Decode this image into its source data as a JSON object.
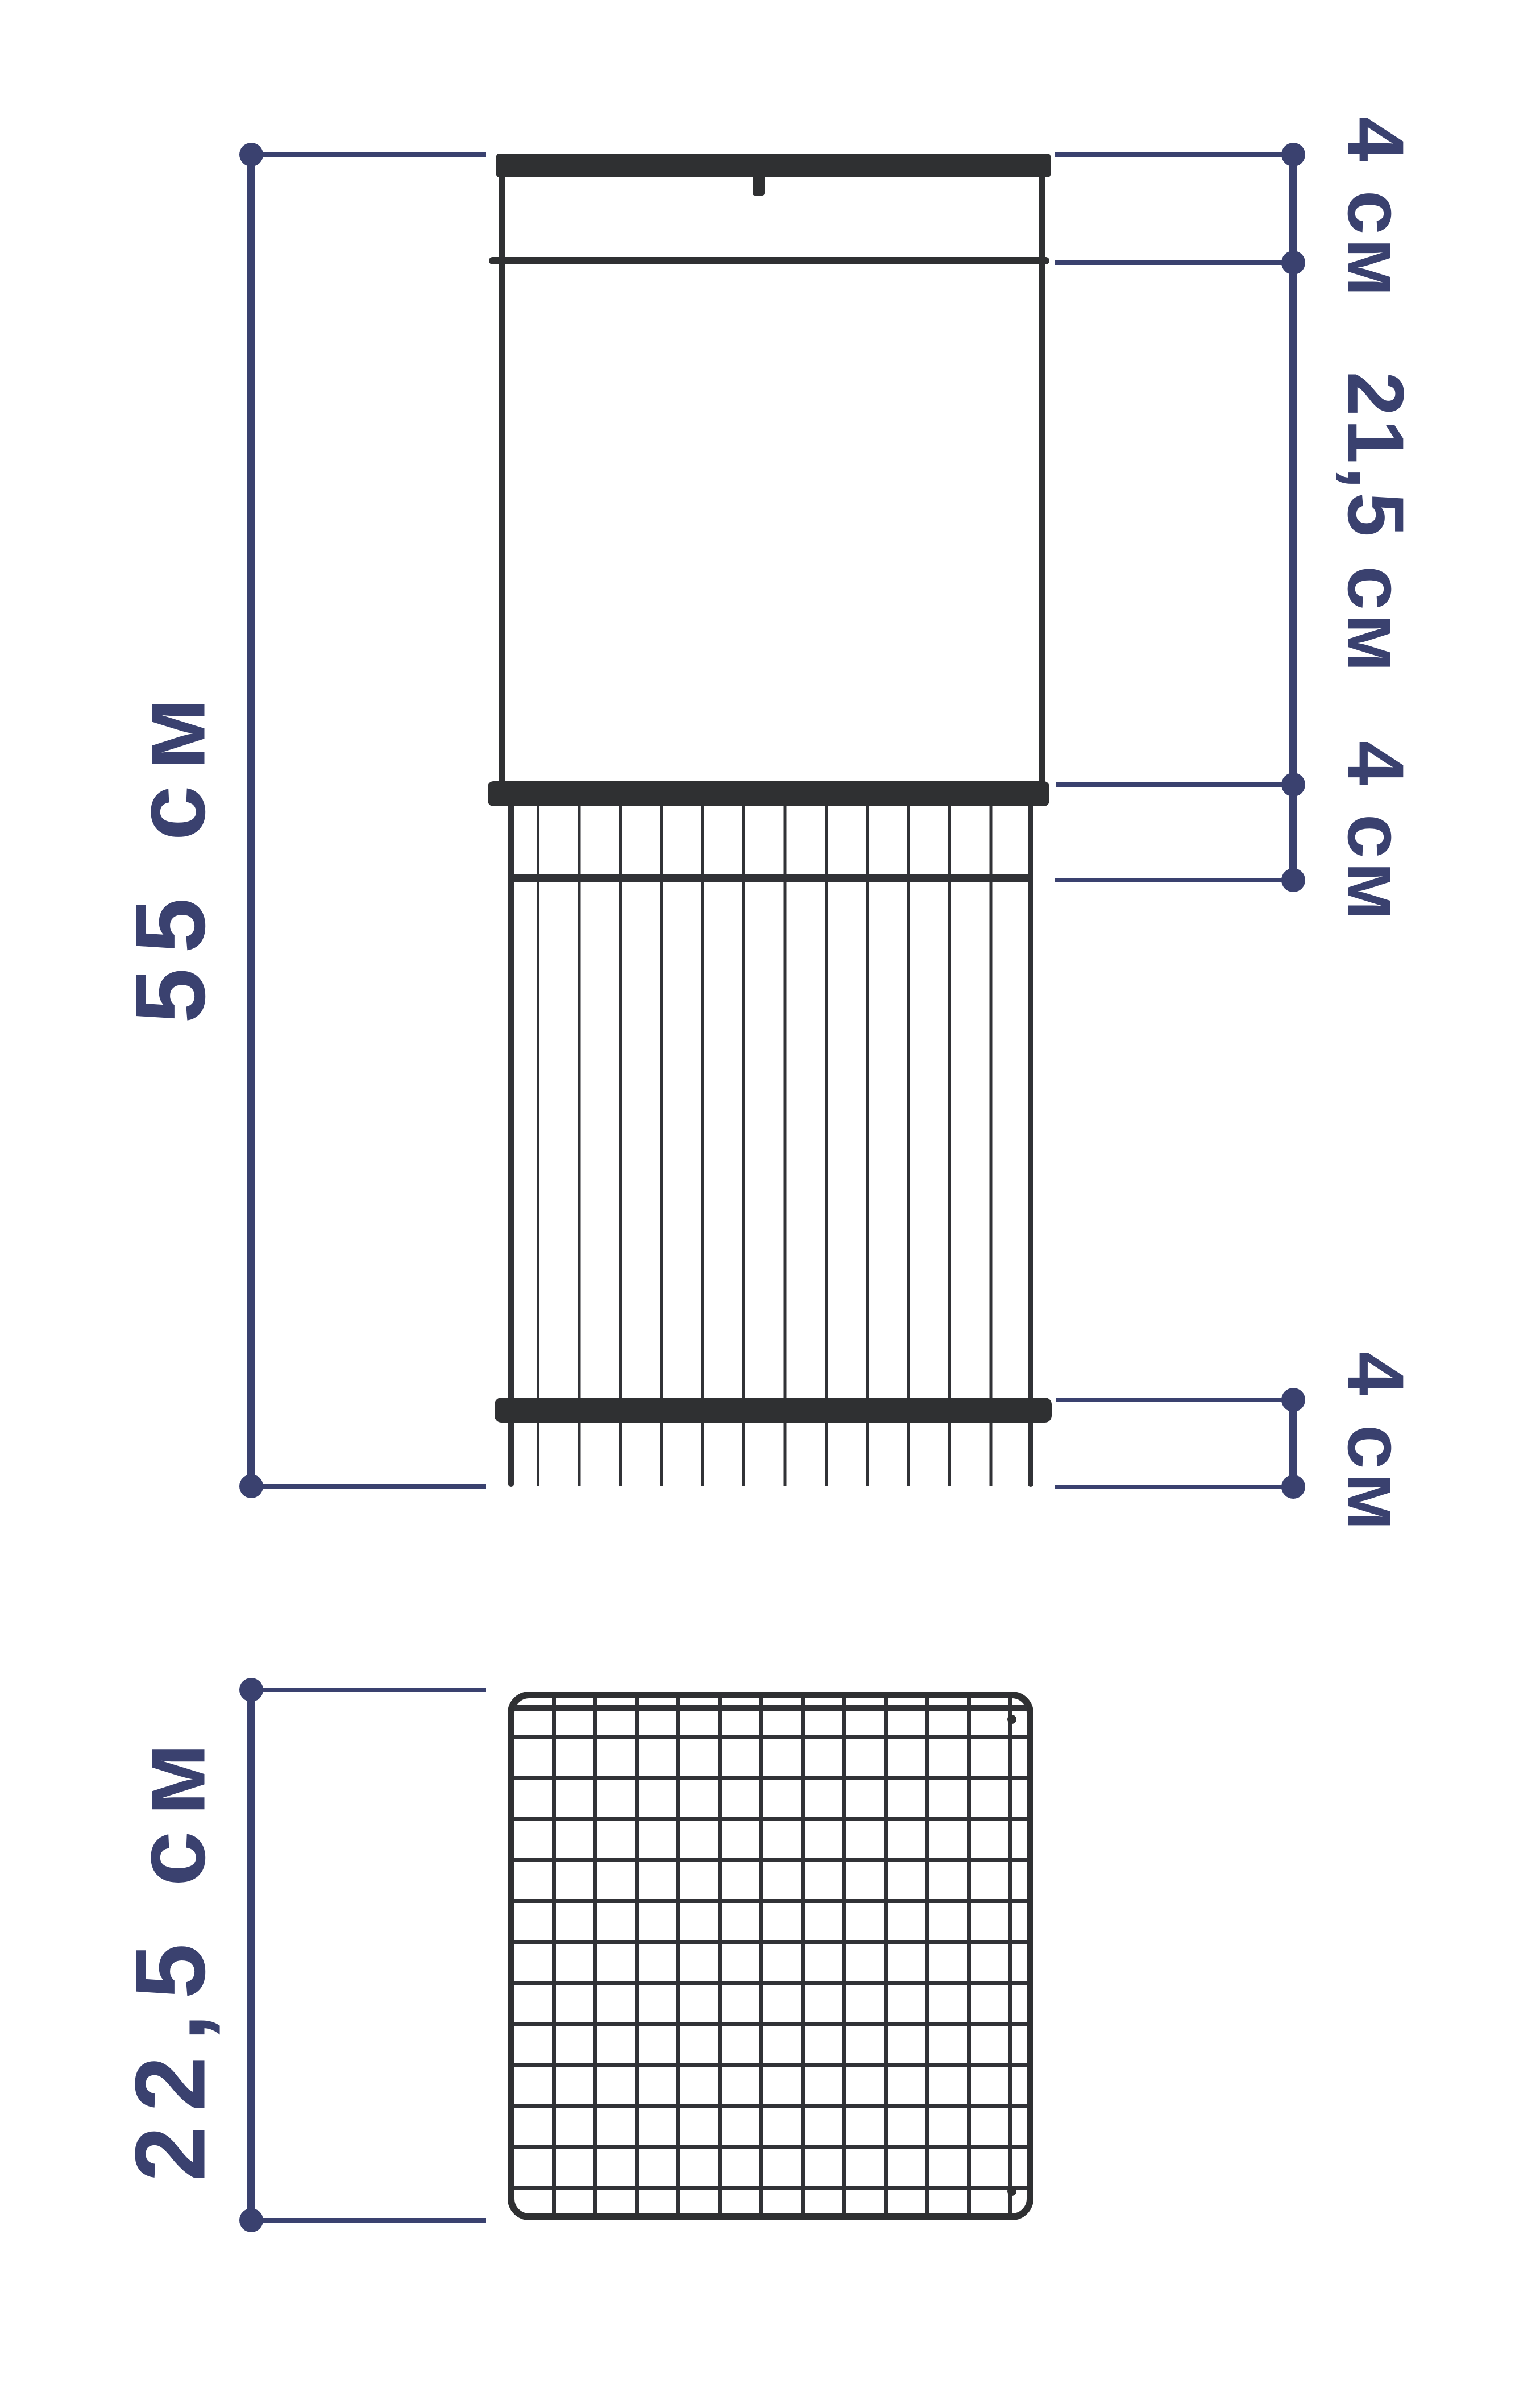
{
  "colors": {
    "dimension_accent": "#3A416F",
    "product_dark": "#2F3032",
    "wire": "#313236",
    "background": "#FFFFFF"
  },
  "front_view": {
    "dimensions": {
      "total_height": "55 см",
      "top_section": "4 см",
      "panel_height": "21,5 см",
      "rim_section": "4 см",
      "bottom_section": "4 см"
    }
  },
  "top_view": {
    "dimensions": {
      "depth": "22,5 см"
    }
  }
}
